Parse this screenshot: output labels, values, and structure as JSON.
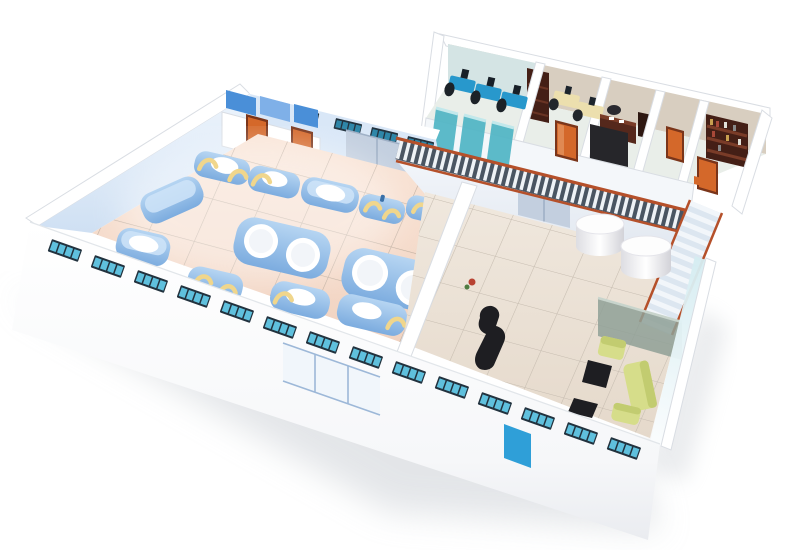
{
  "scene": {
    "view": "isometric-3d-cutaway",
    "subject": "factory-floor-plan",
    "areas": {
      "production_hall": {
        "machines": 14,
        "machine_style": "rounded-blue-tanks-with-white-tops",
        "pipe_arcs": "yellow",
        "restroom_stalls": 2,
        "back_sliding_door": 1,
        "front_glass_door_panels": 3
      },
      "office_mezzanine": {
        "rooms": 5,
        "cubicle_workstations": 3,
        "bookshelves": 2,
        "cream_desks": 2,
        "executive_desk": 1,
        "orange_doors": 3,
        "black_panels": 2,
        "railing": true,
        "staircase": true
      },
      "lobby": {
        "round_tables": 2,
        "reception_desk": 1,
        "sofa_pieces": 3,
        "coffee_tables": 2,
        "glass_screen": 1,
        "blue_entrance_door": 1,
        "under_mezzanine_sliding_door": 1
      },
      "front_wall_windows": 14,
      "back_wall_windows": 5
    }
  },
  "colors": {
    "wall_white": "#ffffff",
    "wall_blue": "#d9e7f7",
    "inner_beige": "#d8cec0",
    "inner_green": "#d4e4e4",
    "window_frame": "#22323e",
    "window_pane": "#5fc0dd",
    "window_pane_dark": "#2e86a8",
    "door_orange": "#d4682a",
    "door_orange_dark": "#7a351a",
    "door_orange_light": "#e08952",
    "door_blue": "#2f9fd8",
    "slide_gray": "#c3cfdf",
    "slide_gray_line": "#9fb0c6",
    "floor_hall_a": "#f9e4d6",
    "floor_hall_b": "#f1d3c1",
    "floor_lobby_a": "#f0e8de",
    "floor_lobby_b": "#e5d9cb",
    "tile_hall": "#bfae9f",
    "tile_lobby": "#c6bcb0",
    "machine_a": "#b6d5f2",
    "machine_b": "#7cacdf",
    "machine_light": "#cfe4f8",
    "machine_white": "#ffffff",
    "pipe_yellow": "#f0d68c",
    "cubicle_teal": "#50b5c5",
    "cubicle_teal_light": "#bfe8ec",
    "desk_blue": "#2898cc",
    "desk_cream": "#ecdfae",
    "dark": "#1e1e22",
    "dark_soft": "#2a2a30",
    "wood_dark": "#441f16",
    "wood_mid": "#6a3424",
    "wood_light": "#7a3c28",
    "sofa": "#d6dd8a",
    "sofa_dark": "#c2cc70",
    "railing_orange": "#b5502a",
    "railing_base": "#4a5562",
    "railing_picket": "#eef2f6",
    "stair_base": "#dce6f0",
    "stair_step": "#f2f6fa",
    "glass_wall": "#d4ecf1",
    "screen_green": "#8fa096",
    "shadow": "#cdd1d7"
  }
}
